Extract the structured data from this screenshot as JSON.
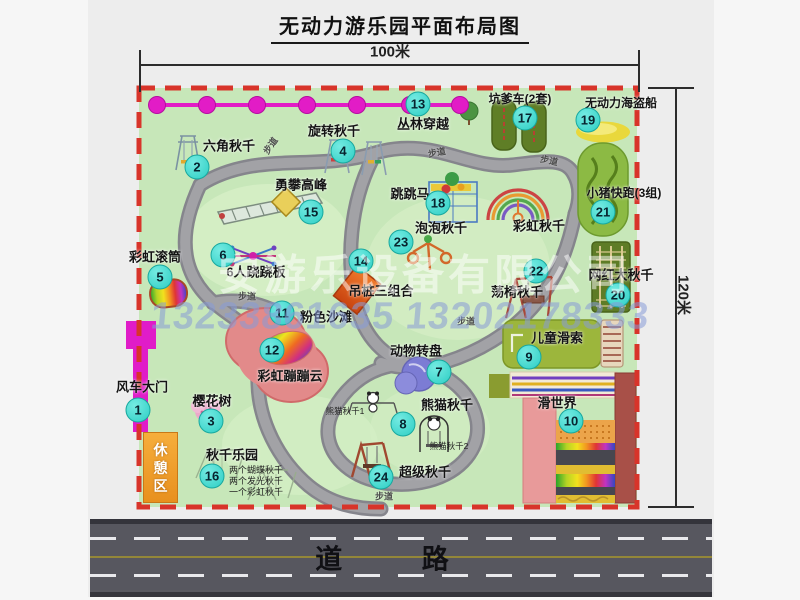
{
  "title": "无动力游乐园平面布局图",
  "dimensions": {
    "width": "100米",
    "height": "120米"
  },
  "road": {
    "label": "道 路"
  },
  "watermarks": {
    "company": "安游乐设备有限公司",
    "phone": "13233861635 13202178333"
  },
  "zones": {
    "rest_area": "休憩区"
  },
  "path_label": "步道",
  "markers": [
    {
      "num": "1",
      "label": "风车大门"
    },
    {
      "num": "2",
      "label": "六角秋千"
    },
    {
      "num": "3",
      "label": "樱花树"
    },
    {
      "num": "4",
      "label": "旋转秋千"
    },
    {
      "num": "5",
      "label": "彩虹滚筒"
    },
    {
      "num": "6",
      "label": "6人跷跷板"
    },
    {
      "num": "7",
      "label": "动物转盘"
    },
    {
      "num": "8",
      "label": "熊猫秋千"
    },
    {
      "num": "9",
      "label": "儿童滑索"
    },
    {
      "num": "10",
      "label": "滑世界"
    },
    {
      "num": "11",
      "label": "粉色沙滩"
    },
    {
      "num": "12",
      "label": "彩虹蹦蹦云"
    },
    {
      "num": "13",
      "label": "丛林穿越"
    },
    {
      "num": "14",
      "label": "吊桩三组合"
    },
    {
      "num": "15",
      "label": "勇攀高峰"
    },
    {
      "num": "16",
      "label": "秋千乐园"
    },
    {
      "num": "17",
      "label": "坑爹车(2套)"
    },
    {
      "num": "18",
      "label": "跳跳马"
    },
    {
      "num": "19",
      "label": "无动力海盗船"
    },
    {
      "num": "20",
      "label": "网红大秋千"
    },
    {
      "num": "21",
      "label": "小猪快跑(3组)"
    },
    {
      "num": "22",
      "label": "荡椅秋千"
    },
    {
      "num": "23",
      "label": "泡泡秋千"
    },
    {
      "num": "24",
      "label": "超级秋千"
    }
  ],
  "extra_labels": {
    "rainbow_swing": "彩虹秋千"
  },
  "sub_labels": {
    "panda1": "熊猫秋千1",
    "panda2": "熊猫秋千2",
    "swing_notes": [
      "两个蝴蝶秋千",
      "两个发光秋千",
      "一个彩虹秋千"
    ]
  },
  "colors": {
    "boundary_red": "#d8342a",
    "marker_cyan": "#2ecec4",
    "zipline_magenta": "#e21cc6",
    "park_green": "#c7e7b9",
    "road_gray": "#57575f",
    "rest_area_orange": "#f0a030"
  }
}
